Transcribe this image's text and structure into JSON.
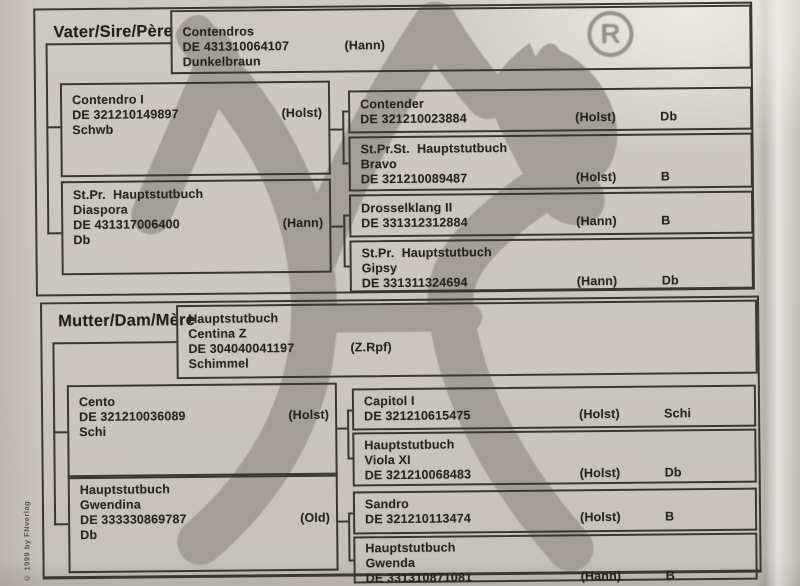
{
  "page": {
    "copyright": "© 1999 by FNverlag",
    "registered_mark": "R",
    "paper_color": "#cbc7c0",
    "watermark_color": "#a19d96",
    "line_color": "#3a3731"
  },
  "sire": {
    "header_bold": "Vater",
    "header_rest": "/Sire/Père",
    "subject": {
      "name": "Contendros",
      "id": "DE 431310064107",
      "registry": "(Hann)",
      "color": "Dunkelbraun"
    },
    "father": {
      "name": "Contendro I",
      "id": "DE 321210149897",
      "registry": "(Holst)",
      "color": "Schwb"
    },
    "father_father": {
      "name": "Contender",
      "id": "DE 321210023884",
      "registry": "(Holst)",
      "color_code": "Db"
    },
    "father_mother": {
      "title": "St.Pr.St.  Hauptstutbuch",
      "name": "Bravo",
      "id": "DE 321210089487",
      "registry": "(Holst)",
      "color_code": "B"
    },
    "mother": {
      "title": "St.Pr.  Hauptstutbuch",
      "name": "Diaspora",
      "id": "DE 431317006400",
      "registry": "(Hann)",
      "color": "Db"
    },
    "mother_father": {
      "name": "Drosselklang II",
      "id": "DE 331312312884",
      "registry": "(Hann)",
      "color_code": "B"
    },
    "mother_mother": {
      "title": "St.Pr.  Hauptstutbuch",
      "name": "Gipsy",
      "id": "DE 331311324694",
      "registry": "(Hann)",
      "color_code": "Db"
    }
  },
  "dam": {
    "header_bold": "Mutter",
    "header_rest": "/Dam/Mère",
    "subject": {
      "title": "Hauptstutbuch",
      "name": "Centina Z",
      "id": "DE 304040041197",
      "registry": "(Z.Rpf)",
      "color": "Schimmel"
    },
    "father": {
      "name": "Cento",
      "id": "DE 321210036089",
      "registry": "(Holst)",
      "color": "Schi"
    },
    "father_father": {
      "name": "Capitol I",
      "id": "DE 321210615475",
      "registry": "(Holst)",
      "color_code": "Schi"
    },
    "father_mother": {
      "title": "Hauptstutbuch",
      "name": "Viola XI",
      "id": "DE 321210068483",
      "registry": "(Holst)",
      "color_code": "Db"
    },
    "mother": {
      "title": "Hauptstutbuch",
      "name": "Gwendina",
      "id": "DE 333330869787",
      "registry": "(Old)",
      "color": "Db"
    },
    "mother_father": {
      "name": "Sandro",
      "id": "DE 321210113474",
      "registry": "(Holst)",
      "color_code": "B"
    },
    "mother_mother": {
      "title": "Hauptstutbuch",
      "name": "Gwenda",
      "id": "DE 331310871081",
      "registry": "(Hann)",
      "color_code": "B"
    }
  }
}
